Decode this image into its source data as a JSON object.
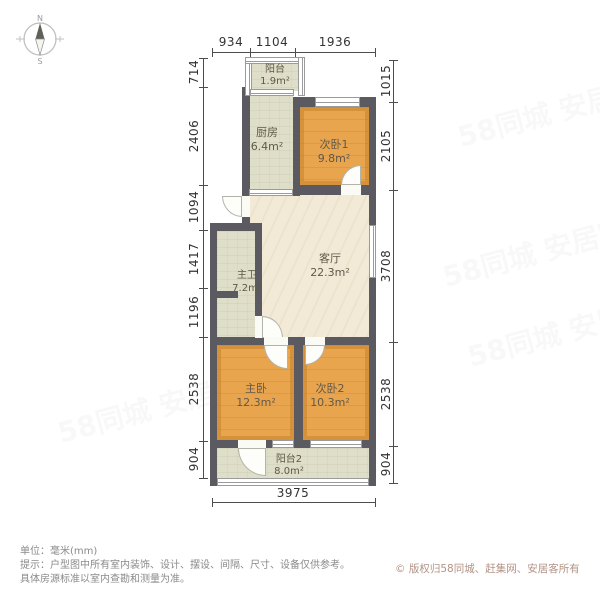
{
  "compass": {
    "north_label": "N",
    "south_label": "S"
  },
  "rooms": [
    {
      "id": "balcony-1",
      "name": "阳台",
      "area": "1.9m²"
    },
    {
      "id": "kitchen",
      "name": "厨房",
      "area": "6.4m²"
    },
    {
      "id": "bedroom-1",
      "name": "次卧1",
      "area": "9.8m²"
    },
    {
      "id": "living",
      "name": "客厅",
      "area": "22.3m²"
    },
    {
      "id": "bathroom",
      "name": "主卫",
      "area": "7.2m²"
    },
    {
      "id": "master",
      "name": "主卧",
      "area": "12.3m²"
    },
    {
      "id": "bedroom-2",
      "name": "次卧2",
      "area": "10.3m²"
    },
    {
      "id": "balcony-2",
      "name": "阳台2",
      "area": "8.0m²"
    }
  ],
  "dimensions": {
    "top": [
      "934",
      "1104",
      "1936"
    ],
    "left": [
      "714",
      "2406",
      "1094",
      "1417",
      "1196",
      "2538",
      "904"
    ],
    "right": [
      "1015",
      "2105",
      "3708",
      "2538",
      "904"
    ],
    "bottom": [
      "3975"
    ]
  },
  "notes": {
    "unit": "单位：毫米(mm)",
    "tip_line1": "提示：户型图中所有室内装饰、设计、摆设、间隔、尺寸、设备仅供参考。",
    "tip_line2": "具体房源标准以室内查勘和测量为准。",
    "copyright": "© 版权归58同城、赶集网、安居客所有"
  },
  "watermarks": [
    "58同城 安居客",
    "58同城 安居客",
    "58同城 安居客",
    "58同城 安居客"
  ],
  "colors": {
    "wall": "#5A5A60",
    "bedroom_floor": "#E9A54E",
    "living_floor": "#F2EAD6",
    "service_floor": "#DFDFC9",
    "dimension_text": "#333333",
    "note_text": "#8A8A8A",
    "copyright_text": "#B29386"
  }
}
